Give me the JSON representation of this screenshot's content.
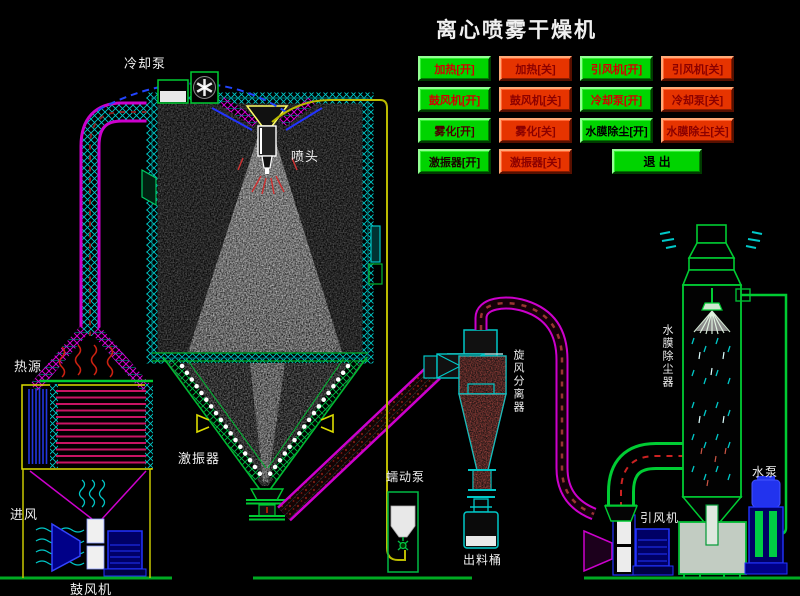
{
  "title": "离心喷雾干燥机",
  "colors": {
    "background": "#000000",
    "button_on_green": "#00d400",
    "button_off_red": "#e63400",
    "pipe_magenta": "#cc00cc",
    "pipe_cyan": "#00c8c8",
    "pipe_green": "#00bb33",
    "pipe_yellow": "#c8c800",
    "machine_blue": "#2233ee",
    "label_white": "#efefef"
  },
  "control_panel": {
    "buttons": [
      {
        "name": "btn-heating-on",
        "label": "加热[开]",
        "state": "on",
        "text_color": "#d40000"
      },
      {
        "name": "btn-heating-off",
        "label": "加热[关]",
        "state": "off",
        "text_color": "#8b0000"
      },
      {
        "name": "btn-induced-fan-on",
        "label": "引风机[开]",
        "state": "on",
        "text_color": "#d40000"
      },
      {
        "name": "btn-induced-fan-off",
        "label": "引风机[关]",
        "state": "off",
        "text_color": "#8b0000"
      },
      {
        "name": "btn-blower-on",
        "label": "鼓风机[开]",
        "state": "on",
        "text_color": "#d40000"
      },
      {
        "name": "btn-blower-off",
        "label": "鼓风机[关]",
        "state": "off",
        "text_color": "#8b0000"
      },
      {
        "name": "btn-cooling-pump-on",
        "label": "冷却泵[开]",
        "state": "on",
        "text_color": "#d40000"
      },
      {
        "name": "btn-cooling-pump-off",
        "label": "冷却泵[关]",
        "state": "off",
        "text_color": "#8b0000"
      },
      {
        "name": "btn-atomizer-on",
        "label": "雾化[开]",
        "state": "on",
        "text_color": "#4a0000"
      },
      {
        "name": "btn-atomizer-off",
        "label": "雾化[关]",
        "state": "off",
        "text_color": "#8b0000"
      },
      {
        "name": "btn-water-film-on",
        "label": "水膜除尘[开]",
        "state": "on",
        "text_color": "#000000"
      },
      {
        "name": "btn-water-film-off",
        "label": "水膜除尘[关]",
        "state": "off",
        "text_color": "#8b0000"
      },
      {
        "name": "btn-vibrator-on",
        "label": "激振器[开]",
        "state": "on",
        "text_color": "#1a0000"
      },
      {
        "name": "btn-vibrator-off",
        "label": "激振器[关]",
        "state": "off",
        "text_color": "#8b0000"
      },
      {
        "name": "btn-exit",
        "label": "退 出",
        "state": "exit",
        "text_color": "#000000"
      }
    ]
  },
  "diagram_labels": {
    "cooling_pump": "冷却泵",
    "spray_head": "喷头",
    "heat_source": "热源",
    "air_inlet": "进风",
    "blower": "鼓风机",
    "vibrator": "激振器",
    "peristaltic_pump": "蠕动泵",
    "discharge_barrel": "出料桶",
    "cyclone_separator": "旋风分离器",
    "induced_draft_fan": "引风机",
    "water_film_dust_collector": "水膜除尘器",
    "water_pump": "水泵"
  }
}
